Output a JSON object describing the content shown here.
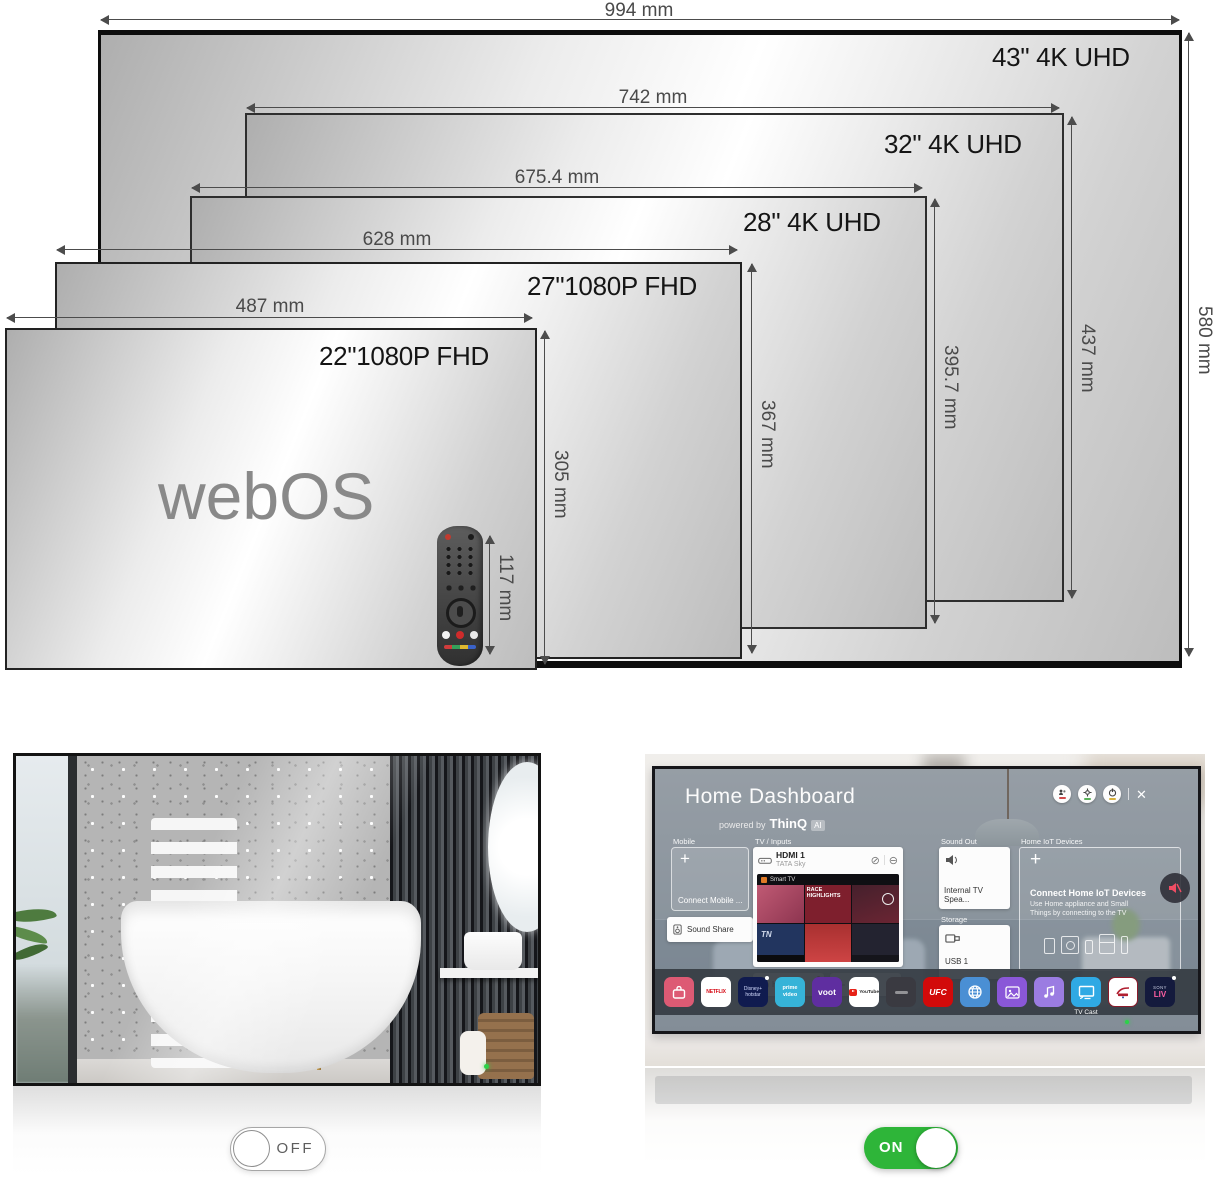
{
  "diagram": {
    "panels": [
      {
        "size_label": "43\" 4K UHD",
        "width_label": "994 mm",
        "height_label": "580 mm"
      },
      {
        "size_label": "32\" 4K UHD",
        "width_label": "742 mm",
        "height_label": "437 mm"
      },
      {
        "size_label": "28\" 4K UHD",
        "width_label": "675.4 mm",
        "height_label": "395.7 mm"
      },
      {
        "size_label": "27\"1080P FHD",
        "width_label": "628 mm",
        "height_label": "367 mm"
      },
      {
        "size_label": "22\"1080P FHD",
        "width_label": "487 mm",
        "height_label": "305 mm"
      }
    ],
    "logo": "webOS",
    "remote_height_label": "117 mm"
  },
  "mirror_off": {
    "toggle_label": "OFF"
  },
  "mirror_on": {
    "toggle_label": "ON",
    "dashboard": {
      "title": "Home Dashboard",
      "powered_by": "powered by",
      "brand": "ThinQ",
      "ai_badge": "AI",
      "icons": {
        "close": "✕",
        "block": "⊘",
        "remove": "⊖"
      },
      "sections": {
        "mobile": "Mobile",
        "tv_inputs": "TV / Inputs",
        "sound_out": "Sound Out",
        "home_iot": "Home IoT Devices",
        "storage": "Storage"
      },
      "mobile_card": {
        "plus": "+",
        "label": "Connect Mobile ..."
      },
      "sound_share": "Sound Share",
      "hdmi_main": {
        "title": "HDMI 1",
        "subtitle": "TATA Sky"
      },
      "preview": {
        "brand": "Smart TV",
        "captions": [
          "RACE HIGHLIGHTS",
          "TN",
          "INSIDE GUYS",
          "CHARLO vs MONTIEL"
        ]
      },
      "inputs_row": {
        "hdmi": "HDMI 1",
        "av": "AV"
      },
      "sound_out_card": "Internal TV Spea...",
      "storage_card": "USB 1",
      "iot_card": {
        "plus": "+",
        "title": "Connect Home IoT Devices",
        "desc": "Use Home appliance and Small Things by connecting to the TV"
      },
      "dock": {
        "netflix": "NETFLIX",
        "disney_line1": "Disney+",
        "disney_line2": "hotstar",
        "prime_line1": "prime",
        "prime_line2": "video",
        "voot": "voot",
        "youtube": "YouTube",
        "ufc": "UFC",
        "tv_cast": "TV Cast",
        "sony": "SONY",
        "liv": "LIV"
      }
    }
  },
  "colors": {
    "toggle_on_green": "#2eb539",
    "led_green": "#2bd348",
    "netflix_red": "#d50914",
    "ufc_red": "#d20a0a",
    "voot_purple": "#5f2ea0",
    "prime_blue": "#36b3d8",
    "tvcast_blue": "#2fa9e4",
    "hotstar_navy": "#101b4f",
    "browser_blue": "#4a8fd4",
    "gallery_purple": "#8a57d8",
    "music_purple": "#9b7ce2",
    "dock_pink": "#dd5a74",
    "sonyliv_navy": "#141a3d",
    "mute_pink": "#e04358"
  }
}
